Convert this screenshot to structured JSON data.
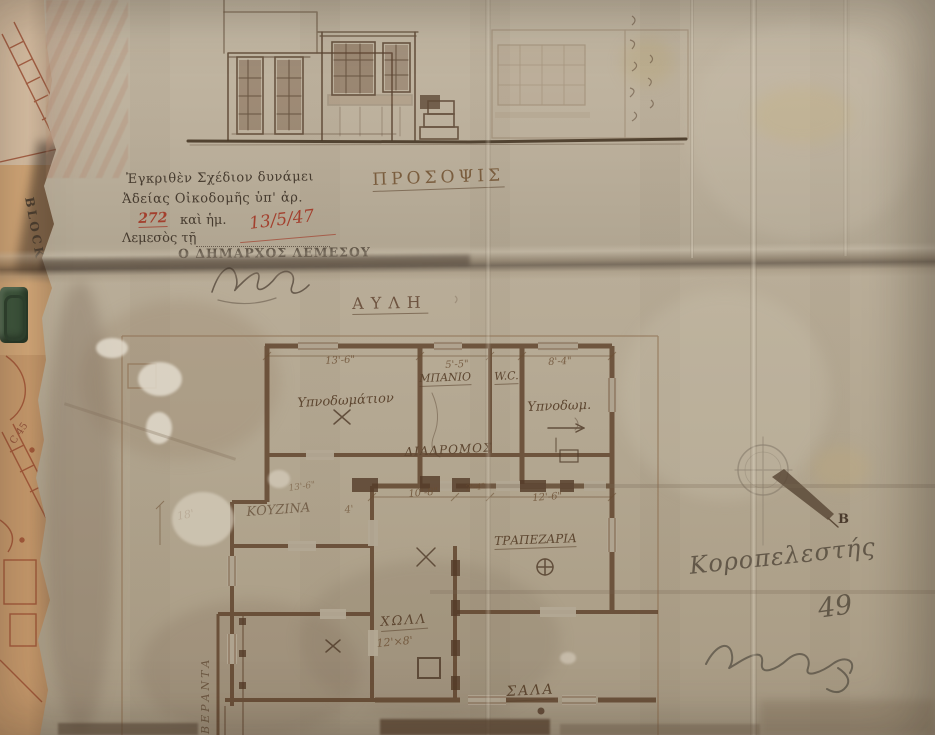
{
  "stamp": {
    "line1": "Ἐγκριθὲν Σχέδιον δυνάμει",
    "line2": "Ἀδείας Οἰκοδομῆς ὑπ' ἀρ.",
    "permit_no": "272",
    "line3_mid": "καὶ ἡμ.",
    "date": "13/5/47",
    "line4": "Λεμεσὸς τῇ",
    "line5": "Ο ΔΗΜΑΡΧΟΣ ΛΕΜΕΣΟΥ"
  },
  "elevation": {
    "title": "ΠΡΟΣΟΨΙΣ"
  },
  "plan": {
    "courtyard": "ΑΥΛΗ",
    "rooms": {
      "bedroom_left": "Υπνοδωμάτιον",
      "bathroom": "ΜΠΑΝΙΟ",
      "wc": "W.C.",
      "bedroom_right": "Υπνοδωμ.",
      "corridor": "ΔΙΑΔΡΟΜΟΣ",
      "kitchen": "ΚΟΥΖΙΝΑ",
      "dining": "ΤΡΑΠΕΖΑΡΙΑ",
      "hall": "ΧΩΛΛ",
      "hall_size": "12'×8'",
      "living": "ΣΑΛΑ",
      "veranda": "ΒΕΡΑΝΤΑ"
    },
    "dimensions": {
      "top_left": "13'-6\"",
      "top_mid": "5'-5\"",
      "top_right": "8'-4\"",
      "mid_left": "10'-8\"",
      "mid_right": "12'-6\"",
      "left": "18'",
      "kitchen_w": "13'-6\"",
      "kitchen_d": "4'",
      "small": "2'-4\""
    },
    "compass_letter": "B"
  },
  "annotations": {
    "note_line1": "Κοροπελεστής",
    "note_line2": "49"
  },
  "under_papers": {
    "block_label": "BLOCK",
    "plot_label": "C 45"
  },
  "colors": {
    "paper": "#b7ac99",
    "ink": "#5a4632",
    "red_ink": "#a3402e",
    "under_orange": "#cf9e6e"
  }
}
